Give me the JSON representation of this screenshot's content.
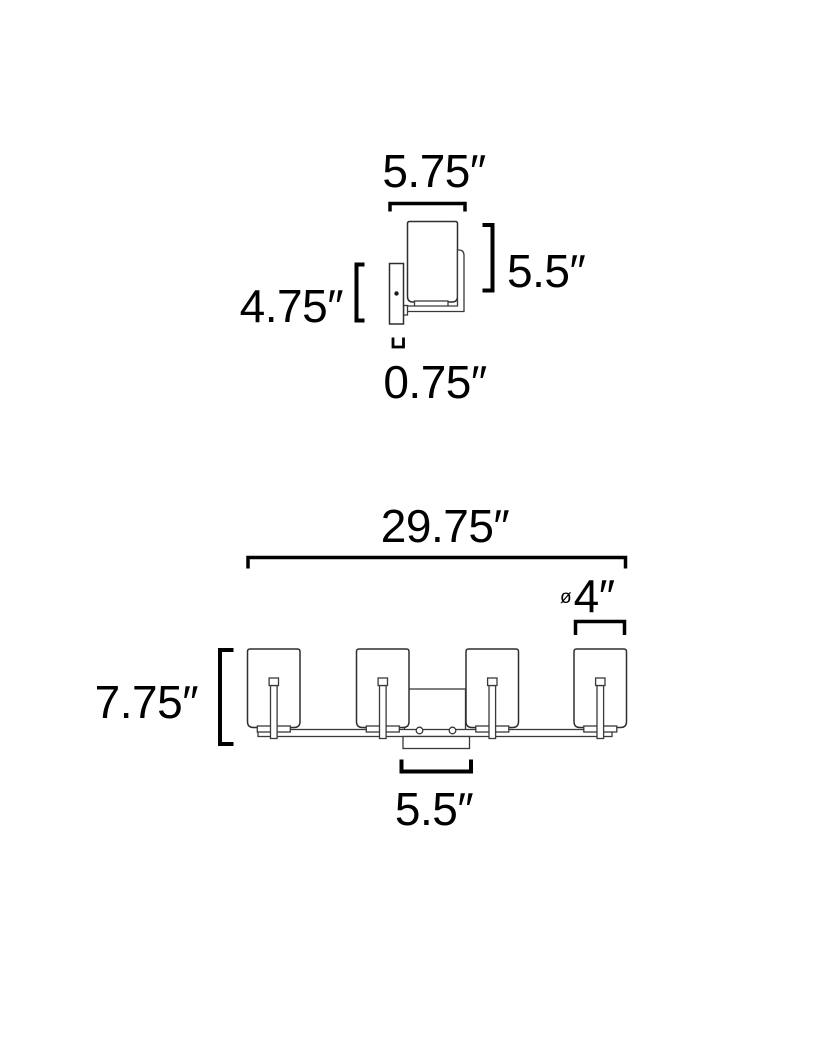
{
  "colors": {
    "background": "#ffffff",
    "fixture_line": "#2f2f2f",
    "dimension_line": "#000000",
    "text": "#000000"
  },
  "side_view": {
    "dim_projection": "5.75″",
    "dim_shade_height": "5.5″",
    "dim_backplate_height": "4.75″",
    "dim_backplate_depth": "0.75″"
  },
  "front_view": {
    "dim_overall_width": "29.75″",
    "dim_shade_diameter_symbol": "ø",
    "dim_shade_diameter": "4″",
    "dim_overall_height": "7.75″",
    "dim_canopy_width": "5.5″"
  }
}
